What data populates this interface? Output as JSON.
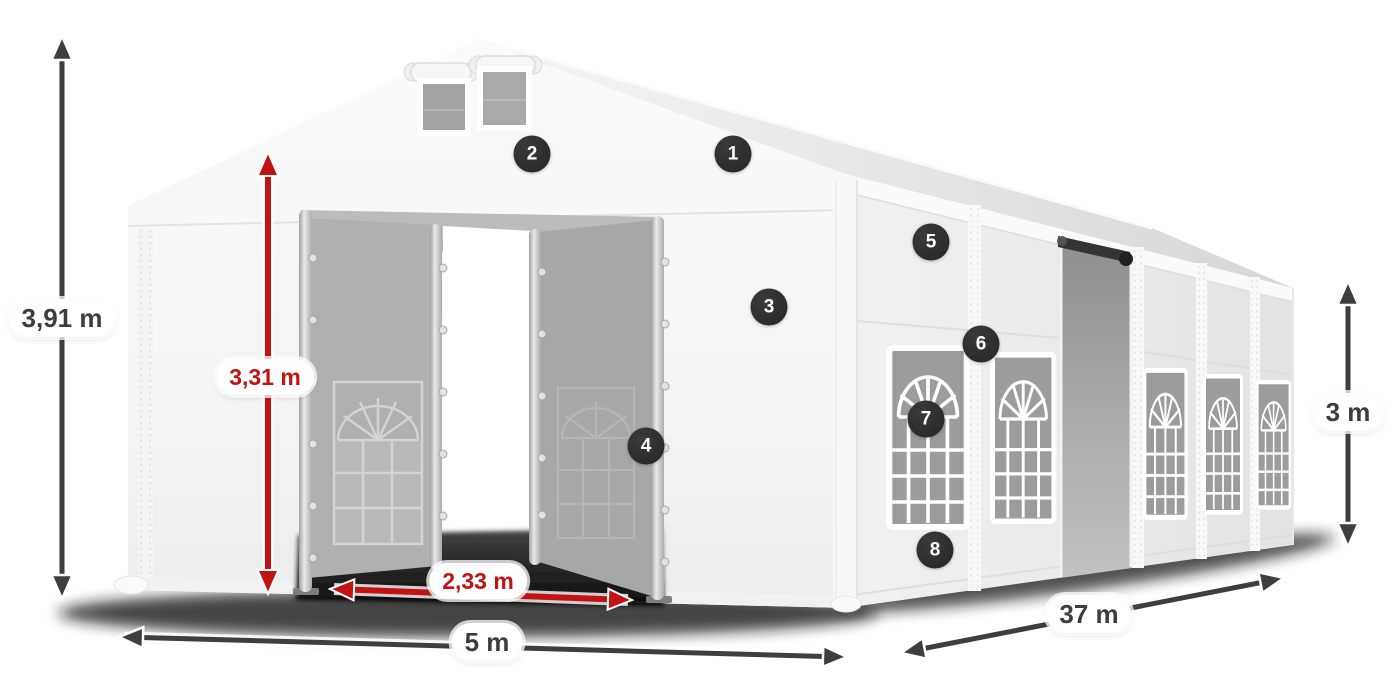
{
  "diagram": {
    "subject": "party-tent-dimension-diagram",
    "badges": [
      {
        "number": "1"
      },
      {
        "number": "2"
      },
      {
        "number": "3"
      },
      {
        "number": "4"
      },
      {
        "number": "5"
      },
      {
        "number": "6"
      },
      {
        "number": "7"
      },
      {
        "number": "8"
      }
    ],
    "dimensions": {
      "total_height": "3,91 m",
      "entrance_height": "3,31 m",
      "entrance_width": "2,33 m",
      "front_width": "5 m",
      "side_length": "37 m",
      "side_wall_height": "3 m"
    },
    "colors": {
      "dimension_red": "#c31212",
      "dimension_dark": "#3e3e3e",
      "badge_background": "#2d2d2d",
      "badge_text": "#ffffff",
      "tent_white": "#f6f6f6",
      "window_glass": "#9c9c9c"
    }
  }
}
